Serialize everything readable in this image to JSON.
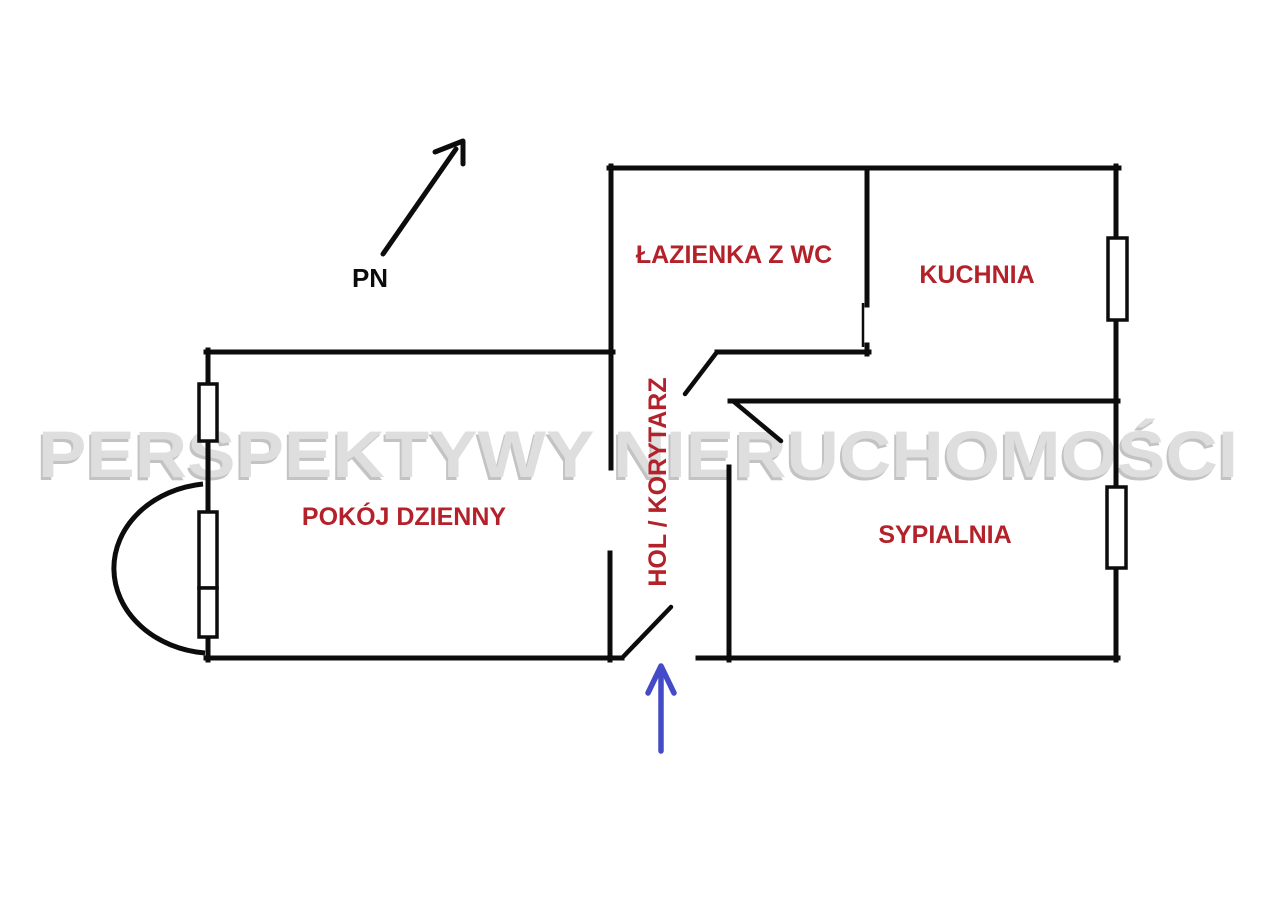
{
  "plan": {
    "watermark": "PERSPEKTYWY NIERUCHOMOŚCI",
    "north_label": "PN",
    "rooms": [
      {
        "label": "ŁAZIENKA Z WC"
      },
      {
        "label": "KUCHNIA"
      },
      {
        "label": "POKÓJ DZIENNY"
      },
      {
        "label": "SYPIALNIA"
      },
      {
        "label": "HOL / KORYTARZ"
      }
    ],
    "colors": {
      "walls": "#0c0c0c",
      "room_label": "#b3222a",
      "entrance_arrow": "#444bc8",
      "watermark": "#dedede"
    }
  }
}
